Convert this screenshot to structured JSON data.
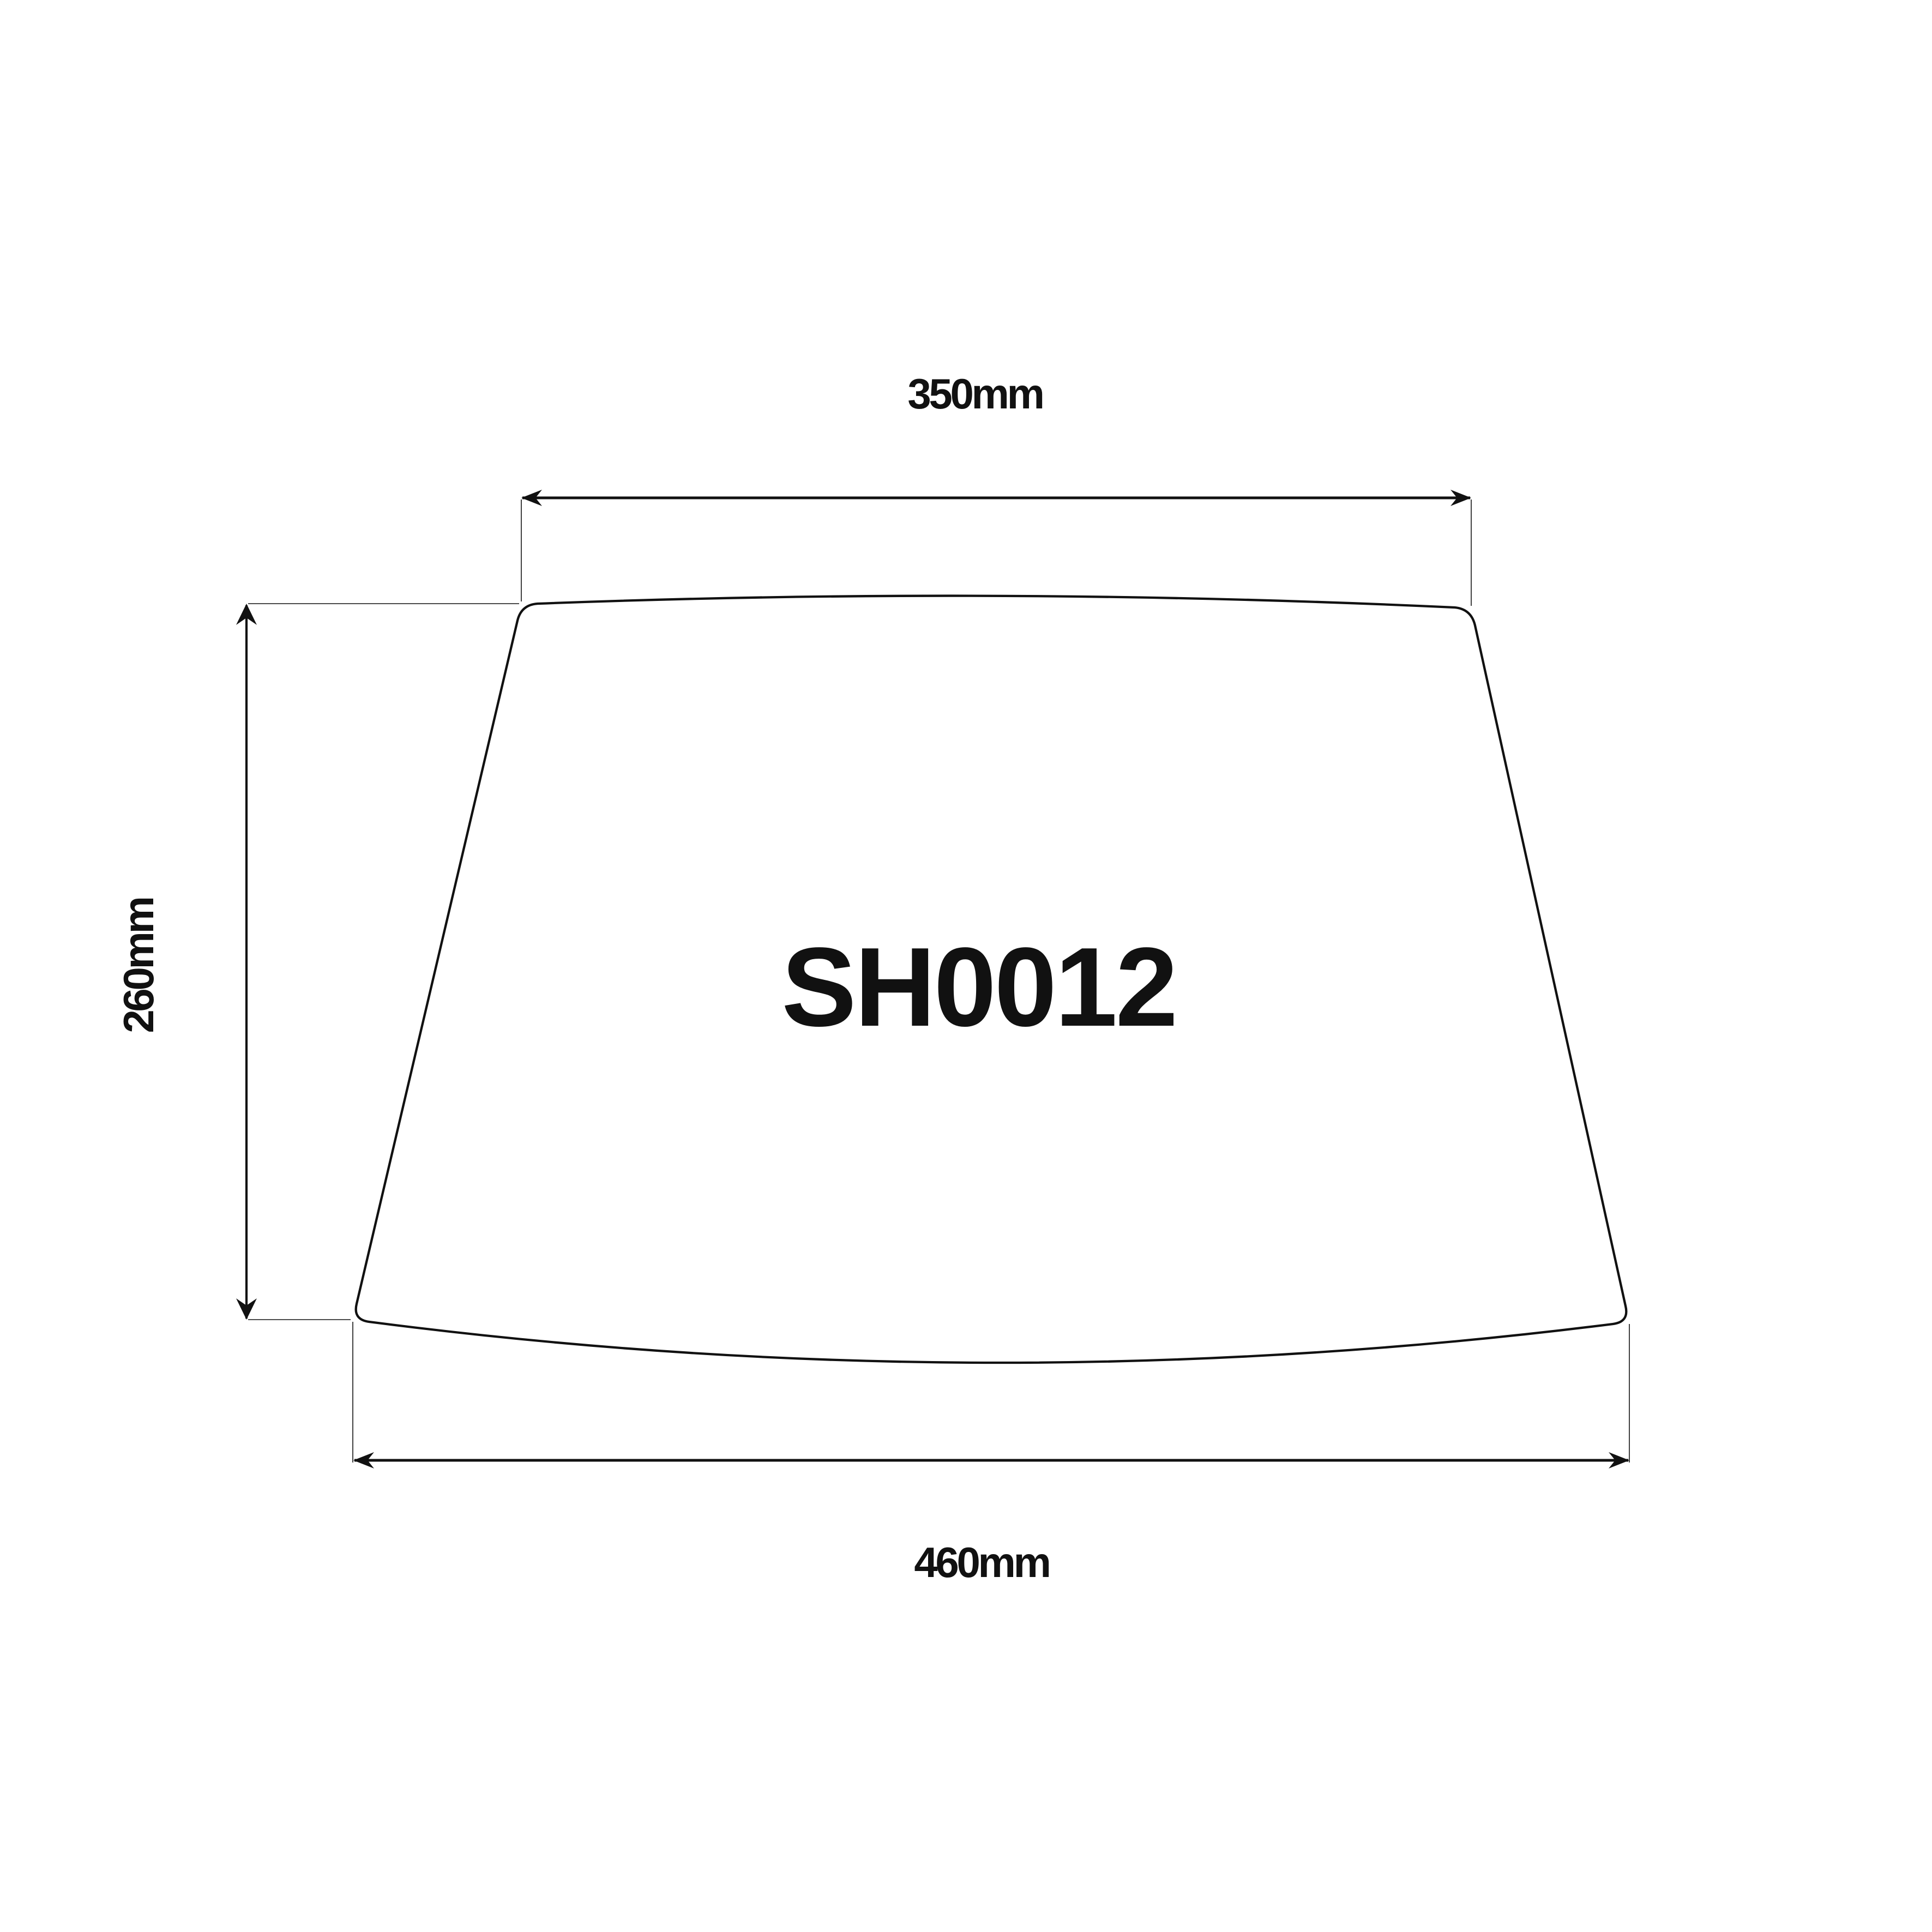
{
  "page": {
    "background_color": "#ffffff",
    "line_color": "#111111"
  },
  "diagram": {
    "type": "lampshade-dimension-drawing",
    "product_code": "SH0012",
    "dimensions": {
      "top_width": {
        "label": "350mm",
        "value": 350,
        "unit": "mm"
      },
      "height": {
        "label": "260mm",
        "value": 260,
        "unit": "mm"
      },
      "bottom_width": {
        "label": "460mm",
        "value": 460,
        "unit": "mm"
      }
    }
  }
}
